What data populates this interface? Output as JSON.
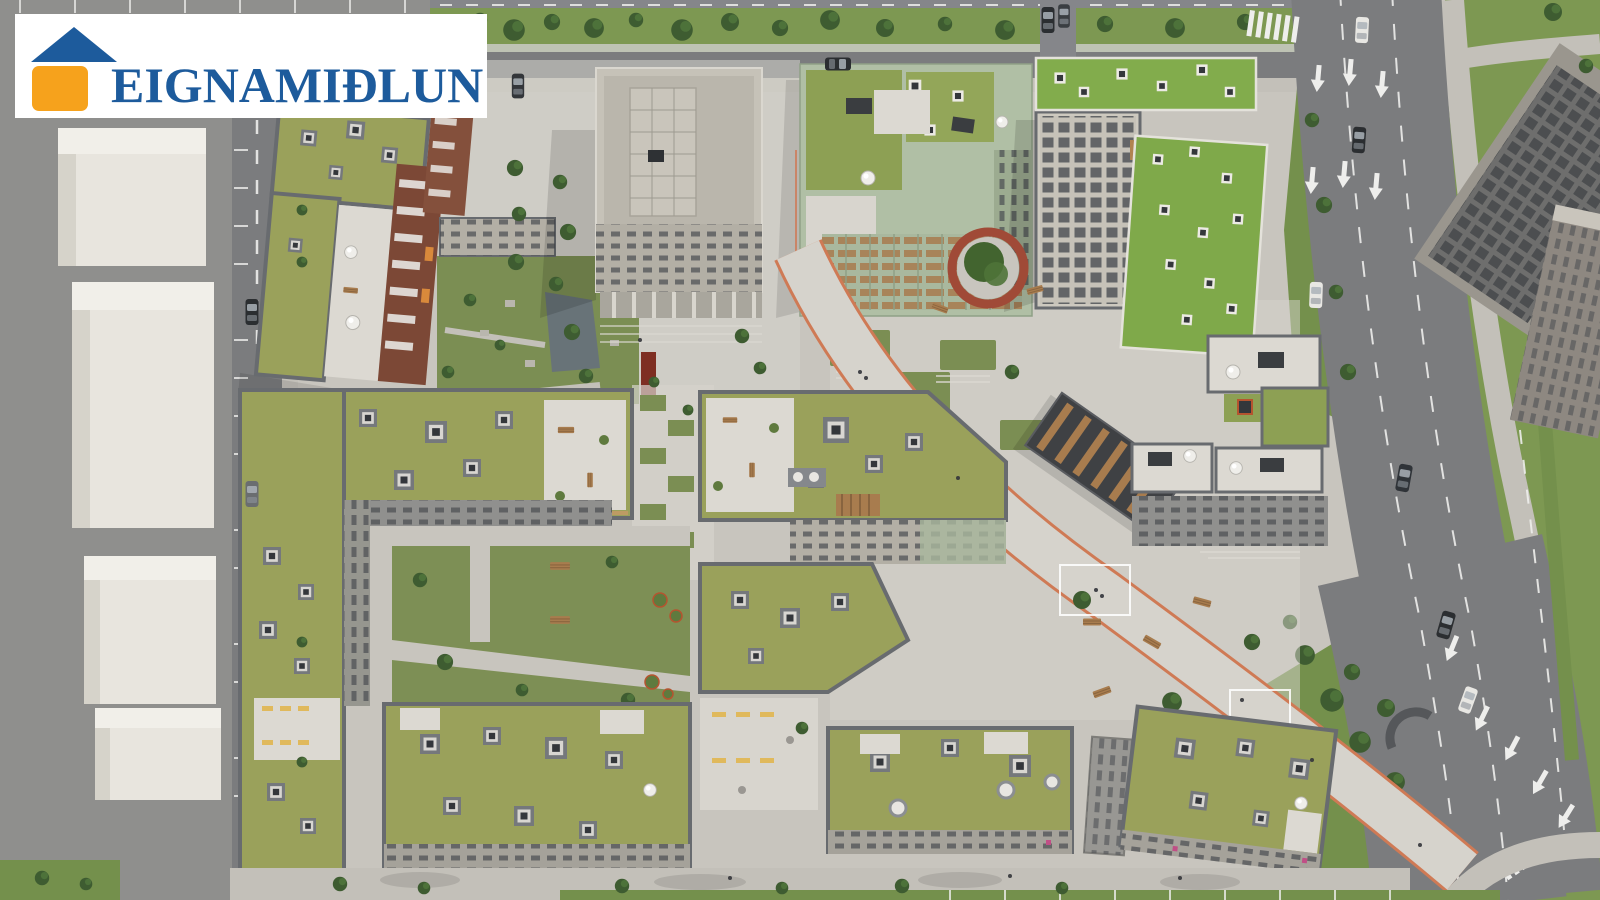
{
  "logo": {
    "brand": "EIGNAMIÐLUN",
    "icon": "house-logo-icon",
    "banner_background": "#ffffff"
  },
  "scene": {
    "kind": "aerial-architectural-rendering",
    "features": [
      "green-roof-apartment-blocks",
      "central-office-building",
      "diagonal-promenade",
      "circular-red-planter",
      "curved-boulevard",
      "parking-lot",
      "courtyard-gardens"
    ]
  },
  "palette": {
    "bannerWhite": "#ffffff",
    "logoBlue": "#1d5b9c",
    "logoOrange": "#f6a21c",
    "pavement": "#c8c5be",
    "pavementLight": "#d6d3cc",
    "sidewalk": "#c3c0b9",
    "asphalt": "#7b7c7e",
    "asphaltLight": "#85868a",
    "lotGray": "#8f8f8d",
    "marking": "#eeeeec",
    "grass": "#74904c",
    "grassVerge": "#7d9852",
    "courtyardGrass": "#7d8f55",
    "stepGrass": "#7b8e53",
    "tree": "#3e5c31",
    "treeLight": "#537a3d",
    "oliveRoof": "#9aa15b",
    "oliveRough": "#8da054",
    "brightRoof": "#82ac4c",
    "parapet": "#686b6f",
    "skyFrame": "#d8d6d1",
    "skyDark": "#34373b",
    "terrace": "#dcd9d2",
    "facadeLight": "#b3afa5",
    "facadeGray": "#90908e",
    "windowDark": "#4a4d52",
    "officeBody": "#c6c2b8",
    "officeRoof": "#bab6ac",
    "sage": "#b0bfa5",
    "sageDark": "#9cab90",
    "brick": "#7c4836",
    "brickLight": "#84503c",
    "wood": "#a87c4e",
    "woodLight": "#c59a66",
    "salmon": "#cf7a55",
    "planterRed": "#a04a37",
    "monumentRed": "#7e2e22",
    "water": "#66707c",
    "paleBox": "#e8e5de",
    "paleBoxTop": "#f1efe9",
    "paleBoxSide": "#d6d3ca",
    "darkGlass": "#3f4144",
    "darkWall": "#9a968e",
    "beigeTower": "#8e8881",
    "shed": "#3a3d40",
    "carDark": "#2b2e31",
    "benchYellow": "#e0b95c",
    "magenta": "#c04f86"
  }
}
